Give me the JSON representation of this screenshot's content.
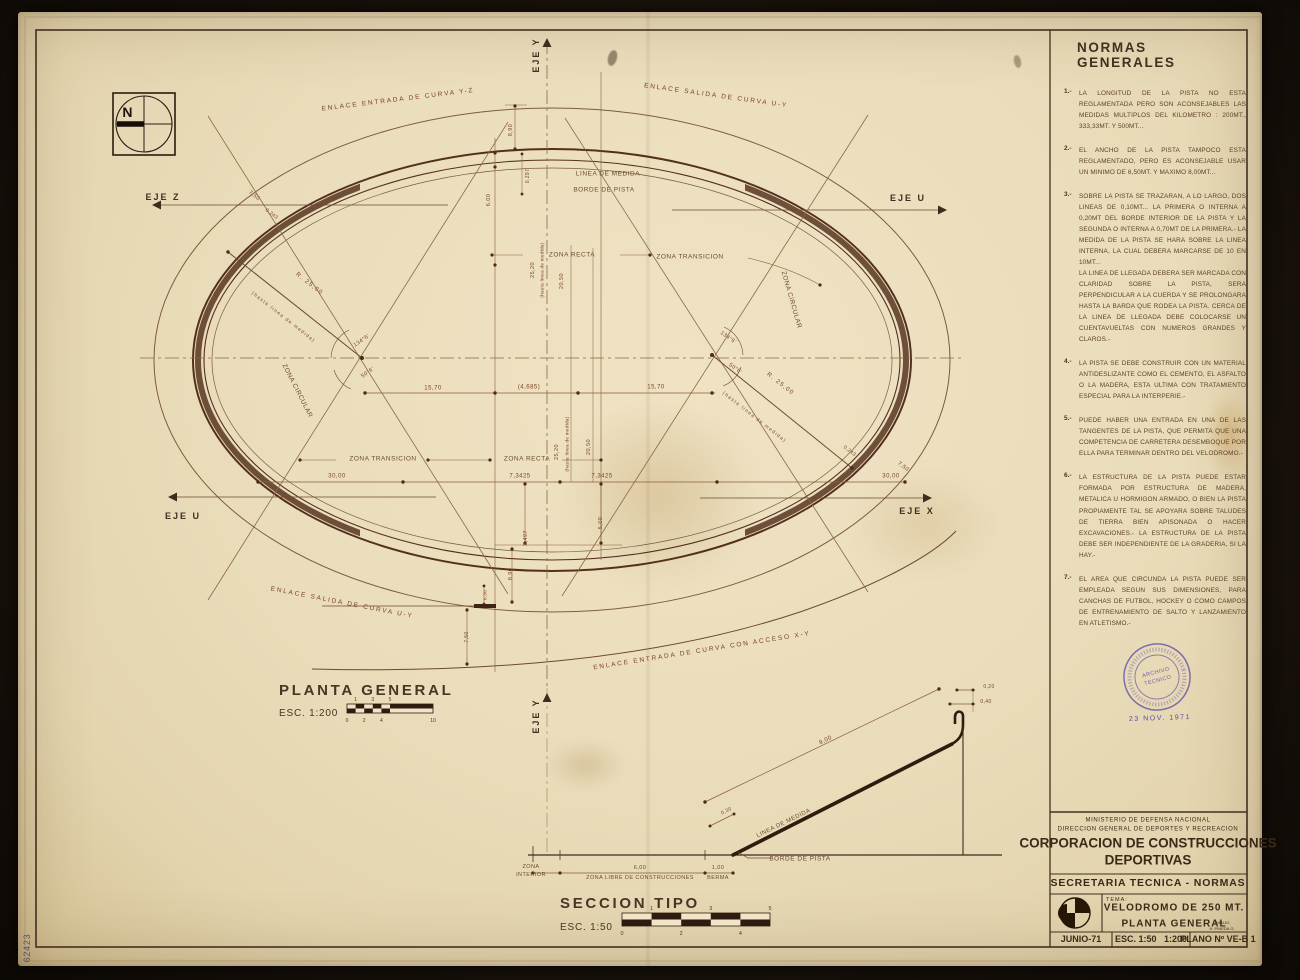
{
  "compass": {
    "label": "N"
  },
  "plan": {
    "title": "PLANTA GENERAL",
    "scale": "ESC. 1:200",
    "axes": {
      "eje_y_top": "EJE Y",
      "eje_y_bottom": "EJE Y",
      "eje_z": "EJE Z",
      "eje_u_right": "EJE U",
      "eje_u_left": "EJE U",
      "eje_x": "EJE X"
    },
    "enlaces": {
      "top_left": "ENLACE ENTRADA DE CURVA Y-Z",
      "top_right": "ENLACE SALIDA DE CURVA U-Y",
      "bottom_left": "ENLACE SALIDA DE CURVA U-Y",
      "bottom_right": "ENLACE ENTRADA DE CURVA CON ACCESO X-Y"
    },
    "lines": {
      "linea_de_medida": "LINEA DE MEDIDA",
      "borde_de_pista": "BORDE DE PISTA"
    },
    "zones": {
      "recta_top": "ZONA RECTA",
      "transicion_top": "ZONA TRANSICION",
      "recta_bottom": "ZONA RECTA",
      "transicion_bottom": "ZONA TRANSICION",
      "circular_left": "ZONA CIRCULAR",
      "circular_right": "ZONA CIRCULAR"
    },
    "radii": {
      "left": "R. 25,00",
      "left_note": "(hasta linea de medida)",
      "right": "R. 25,00",
      "right_note": "(hasta linea de medida)"
    },
    "angles": {
      "left_top": "134°6'",
      "left_bottom": "50°6'",
      "right_top": "134°6'",
      "right_bottom": "50°6'"
    },
    "dims": {
      "d1570a": "15,70",
      "d4685": "(4,685)",
      "d1570b": "15,70",
      "d3000a": "30,00",
      "d73425a": "7,3425",
      "d73425b": "7,3425",
      "d3000b": "30,00",
      "d890top": "8,90",
      "d0297": "0,297",
      "d600": "6,00",
      "d2520top": "25,20",
      "d2520top_note": "(hasta linea de medida)",
      "d2050top": "20,50",
      "d2520bot": "25,20",
      "d2520bot_note": "(hasta linea de medida)",
      "d2050bot": "20,50",
      "d3497": "3,497",
      "d500": "5,00",
      "d890bot": "8,90",
      "d030": "0,30",
      "d750bot": "7,50",
      "d750left": "7,50",
      "d0243left": "0,243",
      "d0243right": "0,243",
      "d750right": "7,50"
    },
    "scalebar": {
      "top": [
        "1",
        "3",
        "5"
      ],
      "bottom": [
        "0",
        "2",
        "4",
        "10"
      ]
    }
  },
  "section": {
    "title": "SECCION TIPO",
    "scale": "ESC. 1:50",
    "labels": {
      "d900": "9,00",
      "linea_de_medida": "LINEA DE MEDIDA",
      "d030": "0,30",
      "d020": "0,20",
      "d040": "0,40",
      "borde_de_pista": "BORDE DE PISTA",
      "zona_interior_1": "ZONA",
      "zona_interior_2": "INTERIOR",
      "d600": "6,00",
      "zona_libre": "ZONA LIBRE DE CONSTRUCCIONES",
      "d100": "1,00",
      "berma": "BERMA"
    },
    "scalebar": {
      "top": [
        "1",
        "3",
        "5"
      ],
      "bottom": [
        "0",
        "2",
        "4"
      ]
    }
  },
  "norms": {
    "title": "NORMAS GENERALES",
    "items": [
      {
        "num": "1.-",
        "text": "LA LONGITUD DE LA PISTA NO ESTA REGLAMENTADA PERO SON ACONSEJABLES LAS MEDIDAS MULTIPLOS DEL KILOMETRO : 200MT., 333,33MT. Y 500MT..."
      },
      {
        "num": "2.-",
        "text": "EL ANCHO DE LA PISTA TAMPOCO ESTA REGLAMENTADO, PERO ES ACONSEJABLE USAR UN MINIMO DE 6,50MT. Y MAXIMO 8,00MT..."
      },
      {
        "num": "3.-",
        "text": "SOBRE LA PISTA SE TRAZARAN, A LO LARGO, DOS LINEAS DE 0,10MT... LA PRIMERA O INTERNA A 0,20MT DEL BORDE INTERIOR DE LA PISTA Y LA SEGUNDA O INTERNA A 0,70MT DE LA PRIMERA.- LA MEDIDA DE LA PISTA SE HARA SOBRE LA LINEA INTERNA, LA CUAL DEBERA MARCARSE DE 10 EN 10MT...\nLA LINEA DE LLEGADA DEBERA SER MARCADA CON CLARIDAD SOBRE LA PISTA, SERA PERPENDICULAR A LA CUERDA Y SE PROLONGARA HASTA LA BARDA QUE RODEA LA PISTA. CERCA DE LA LINEA DE LLEGADA DEBE COLOCARSE UN CUENTAVUELTAS CON NUMEROS GRANDES Y CLAROS.-"
      },
      {
        "num": "4.-",
        "text": "LA PISTA SE DEBE CONSTRUIR CON UN MATERIAL ANTIDESLIZANTE COMO EL CEMENTO, EL ASFALTO O LA MADERA, ESTA ULTIMA CON TRATAMIENTO ESPECIAL PARA LA INTERPERIE.-"
      },
      {
        "num": "5.-",
        "text": "PUEDE HABER UNA ENTRADA EN UNA DE LAS TANGENTES DE LA PISTA, QUE PERMITA QUE UNA COMPETENCIA DE CARRETERA DESEMBOQUE POR ELLA PARA TERMINAR DENTRO DEL VELODROMO.-"
      },
      {
        "num": "6.-",
        "text": "LA ESTRUCTURA DE LA PISTA PUEDE ESTAR FORMADA POR ESTRUCTURA DE MADERA, METALICA U HORMIGON ARMADO, O BIEN LA PISTA PROPIAMENTE TAL SE APOYARA SOBRE TALUDES DE TIERRA BIEN APISONADA O HACER EXCAVACIONES.- LA ESTRUCTURA DE LA PISTA DEBE SER INDEPENDIENTE DE LA GRADERIA, SI LA HAY.-"
      },
      {
        "num": "7.-",
        "text": "EL AREA QUE CIRCUNDA LA PISTA PUEDE SER EMPLEADA SEGUN SUS DIMENSIONES, PARA CANCHAS DE FUTBOL, HOCKEY O COMO CAMPOS DE ENTRENAMIENTO DE SALTO Y LANZAMIENTO EN ATLETISMO.-"
      }
    ]
  },
  "title_block": {
    "ministry": "MINISTERIO DE DEFENSA NACIONAL",
    "direction": "DIRECCION GENERAL DE DEPORTES Y RECREACION",
    "corporation_1": "CORPORACION DE CONSTRUCCIONES",
    "corporation_2": "DEPORTIVAS",
    "secretariat": "SECRETARIA TECNICA - NORMAS",
    "tema_label": "TEMA:",
    "subject_1": "VELODROMO DE 250 MT.",
    "subject_2": "PLANTA GENERAL",
    "drawn_label": "DIBUJO",
    "drawn_by": "H. PINEDA G.",
    "date": "JUNIO-71",
    "scales": "ESC. 1:50   1:200",
    "plan_number": "PLANO Nº VE-B 1"
  },
  "stamp": {
    "line1": "ARCHIVO",
    "line2": "TECNICO",
    "date": "23 NOV. 1971"
  },
  "margin_note": "62423",
  "colors": {
    "ink": "#43301f",
    "track": "#54301c",
    "stamp": "#5b4aa0",
    "paper": "#eaddbb"
  }
}
